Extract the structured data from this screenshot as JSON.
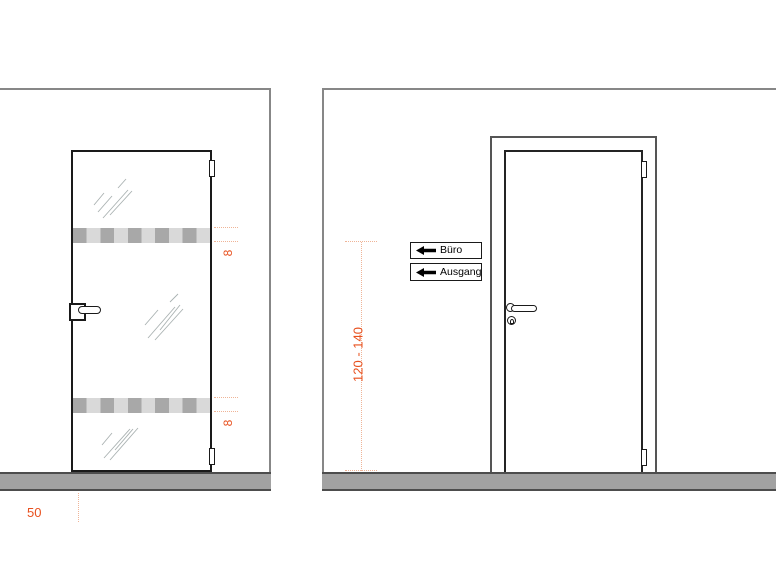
{
  "diagram": {
    "title": "Türkennzeichnung und Beschilderung",
    "language": "de"
  },
  "left_view": {
    "name": "glass-door-with-safety-marking-bands",
    "band_height_top": "8",
    "band_height_bottom": "8",
    "floor_reference": "50"
  },
  "right_view": {
    "name": "door-with-directional-signs",
    "signs": [
      {
        "label": "Büro",
        "icon": "left-arrow-icon"
      },
      {
        "label": "Ausgang",
        "icon": "left-arrow-icon"
      }
    ],
    "sign_mounting_height": "120 - 140"
  },
  "colors": {
    "dimension_accent": "#e8501e",
    "dimension_faint": "#efb497",
    "wall_line": "#878787",
    "floor_fill": "#a2a2a2",
    "door_line": "#1a1a1a",
    "frame_line": "#555555",
    "band_dark": "#a8a8a8",
    "band_light": "#d9d9d9"
  }
}
